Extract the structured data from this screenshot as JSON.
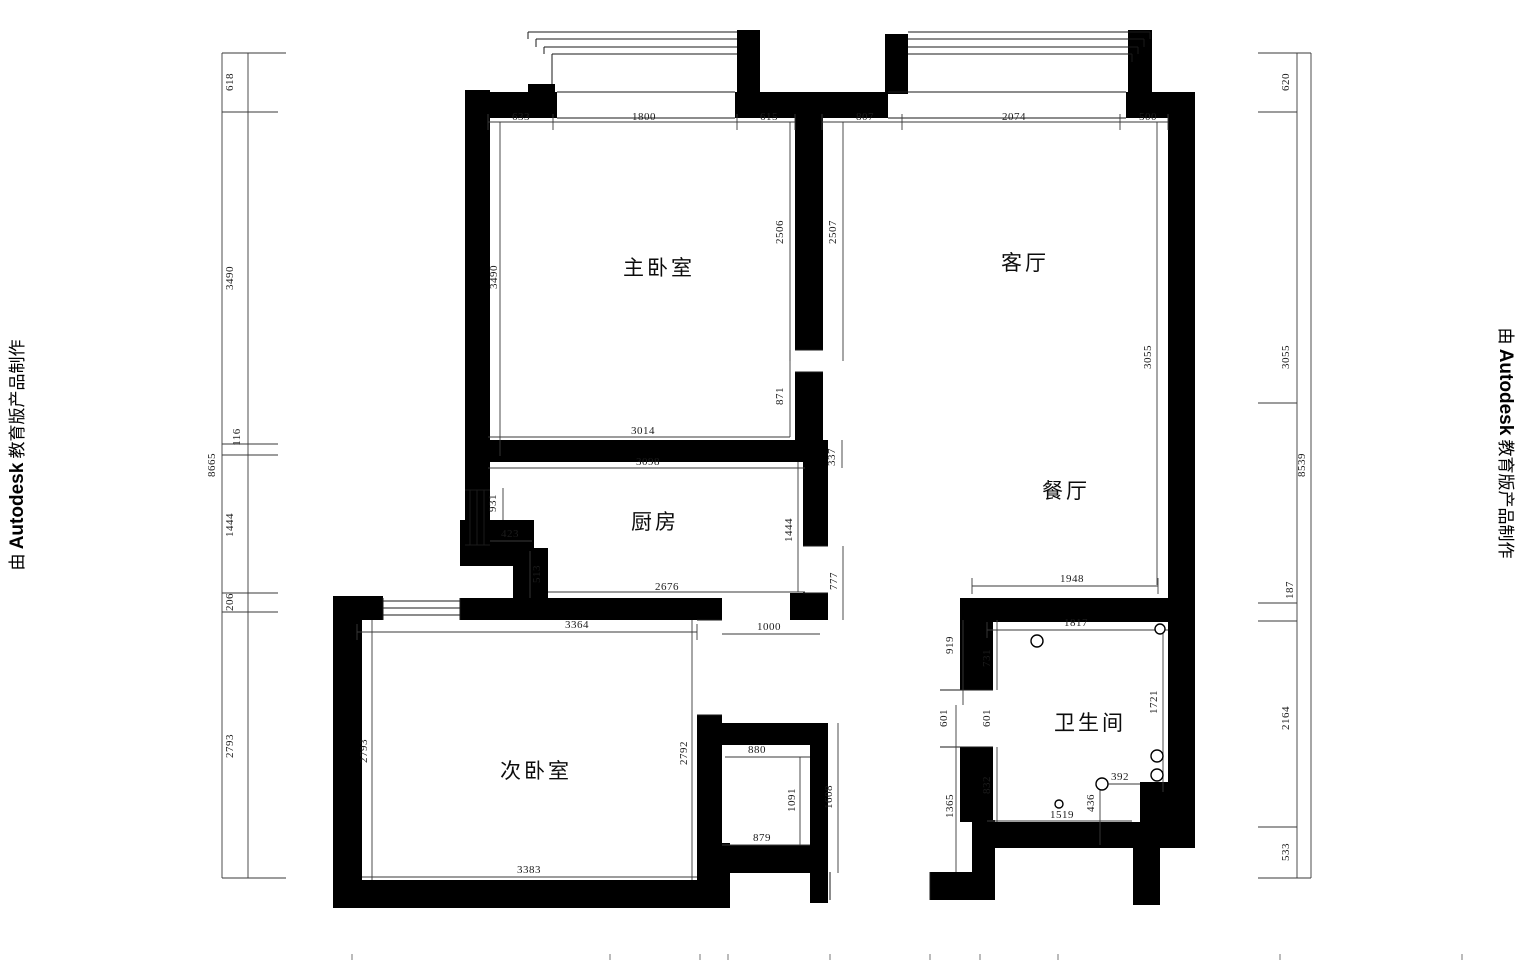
{
  "watermark": {
    "prefix": "由 ",
    "brand": "Autodesk",
    "suffix": " 教育版产品制作"
  },
  "plan": {
    "rooms": [
      {
        "key": "master-bedroom",
        "name": "主卧室",
        "x": 659,
        "y": 275
      },
      {
        "key": "living-room",
        "name": "客厅",
        "x": 1025,
        "y": 270
      },
      {
        "key": "kitchen",
        "name": "厨房",
        "x": 655,
        "y": 529
      },
      {
        "key": "dining-room",
        "name": "餐厅",
        "x": 1066,
        "y": 498
      },
      {
        "key": "second-bedroom",
        "name": "次卧室",
        "x": 536,
        "y": 778
      },
      {
        "key": "bathroom",
        "name": "卫生间",
        "x": 1090,
        "y": 730
      }
    ],
    "dimensions": [
      {
        "v": "633",
        "x": 521,
        "y": 120,
        "rot": 0
      },
      {
        "v": "1800",
        "x": 644,
        "y": 120,
        "rot": 0
      },
      {
        "v": "615",
        "x": 769,
        "y": 120,
        "rot": 0
      },
      {
        "v": "807",
        "x": 865,
        "y": 120,
        "rot": 0
      },
      {
        "v": "2074",
        "x": 1014,
        "y": 120,
        "rot": 0
      },
      {
        "v": "500",
        "x": 1148,
        "y": 120,
        "rot": 0
      },
      {
        "v": "3490",
        "x": 497,
        "y": 277,
        "rot": -90
      },
      {
        "v": "2506",
        "x": 783,
        "y": 232,
        "rot": -90
      },
      {
        "v": "2507",
        "x": 836,
        "y": 232,
        "rot": -90
      },
      {
        "v": "871",
        "x": 783,
        "y": 396,
        "rot": -90
      },
      {
        "v": "3014",
        "x": 643,
        "y": 434,
        "rot": 0
      },
      {
        "v": "337",
        "x": 835,
        "y": 457,
        "rot": -90
      },
      {
        "v": "3098",
        "x": 648,
        "y": 465,
        "rot": 0
      },
      {
        "v": "931",
        "x": 496,
        "y": 503,
        "rot": -90
      },
      {
        "v": "423",
        "x": 510,
        "y": 537,
        "rot": 0
      },
      {
        "v": "513",
        "x": 540,
        "y": 574,
        "rot": -90
      },
      {
        "v": "1444",
        "x": 792,
        "y": 530,
        "rot": -90
      },
      {
        "v": "2676",
        "x": 667,
        "y": 590,
        "rot": 0
      },
      {
        "v": "777",
        "x": 837,
        "y": 581,
        "rot": -90
      },
      {
        "v": "3055",
        "x": 1151,
        "y": 357,
        "rot": -90
      },
      {
        "v": "1948",
        "x": 1072,
        "y": 582,
        "rot": 0
      },
      {
        "v": "3364",
        "x": 577,
        "y": 628,
        "rot": 0
      },
      {
        "v": "2793",
        "x": 367,
        "y": 751,
        "rot": -90
      },
      {
        "v": "2792",
        "x": 687,
        "y": 753,
        "rot": -90
      },
      {
        "v": "3383",
        "x": 529,
        "y": 873,
        "rot": 0
      },
      {
        "v": "1000",
        "x": 769,
        "y": 630,
        "rot": 0
      },
      {
        "v": "880",
        "x": 757,
        "y": 753,
        "rot": 0
      },
      {
        "v": "1091",
        "x": 795,
        "y": 800,
        "rot": -90
      },
      {
        "v": "1608",
        "x": 832,
        "y": 797,
        "rot": -90
      },
      {
        "v": "879",
        "x": 762,
        "y": 841,
        "rot": 0
      },
      {
        "v": "919",
        "x": 953,
        "y": 645,
        "rot": -90
      },
      {
        "v": "731",
        "x": 990,
        "y": 658,
        "rot": -90
      },
      {
        "v": "601",
        "x": 947,
        "y": 718,
        "rot": -90
      },
      {
        "v": "601",
        "x": 990,
        "y": 718,
        "rot": -90
      },
      {
        "v": "832",
        "x": 990,
        "y": 785,
        "rot": -90
      },
      {
        "v": "1365",
        "x": 953,
        "y": 806,
        "rot": -90
      },
      {
        "v": "1817",
        "x": 1076,
        "y": 626,
        "rot": 0
      },
      {
        "v": "1721",
        "x": 1157,
        "y": 702,
        "rot": -90
      },
      {
        "v": "392",
        "x": 1120,
        "y": 780,
        "rot": 0
      },
      {
        "v": "436",
        "x": 1094,
        "y": 803,
        "rot": -90
      },
      {
        "v": "1519",
        "x": 1062,
        "y": 818,
        "rot": 0
      },
      {
        "v": "618",
        "x": 233,
        "y": 82,
        "rot": -90
      },
      {
        "v": "3490",
        "x": 233,
        "y": 278,
        "rot": -90
      },
      {
        "v": "116",
        "x": 240,
        "y": 437,
        "rot": -90
      },
      {
        "v": "8665",
        "x": 215,
        "y": 465,
        "rot": -90
      },
      {
        "v": "1444",
        "x": 233,
        "y": 525,
        "rot": -90
      },
      {
        "v": "206",
        "x": 233,
        "y": 602,
        "rot": -90
      },
      {
        "v": "2793",
        "x": 233,
        "y": 746,
        "rot": -90
      },
      {
        "v": "620",
        "x": 1289,
        "y": 82,
        "rot": -90
      },
      {
        "v": "3055",
        "x": 1289,
        "y": 357,
        "rot": -90
      },
      {
        "v": "8539",
        "x": 1305,
        "y": 465,
        "rot": -90
      },
      {
        "v": "187",
        "x": 1293,
        "y": 590,
        "rot": -90
      },
      {
        "v": "2164",
        "x": 1289,
        "y": 718,
        "rot": -90
      },
      {
        "v": "533",
        "x": 1289,
        "y": 852,
        "rot": -90
      }
    ]
  }
}
